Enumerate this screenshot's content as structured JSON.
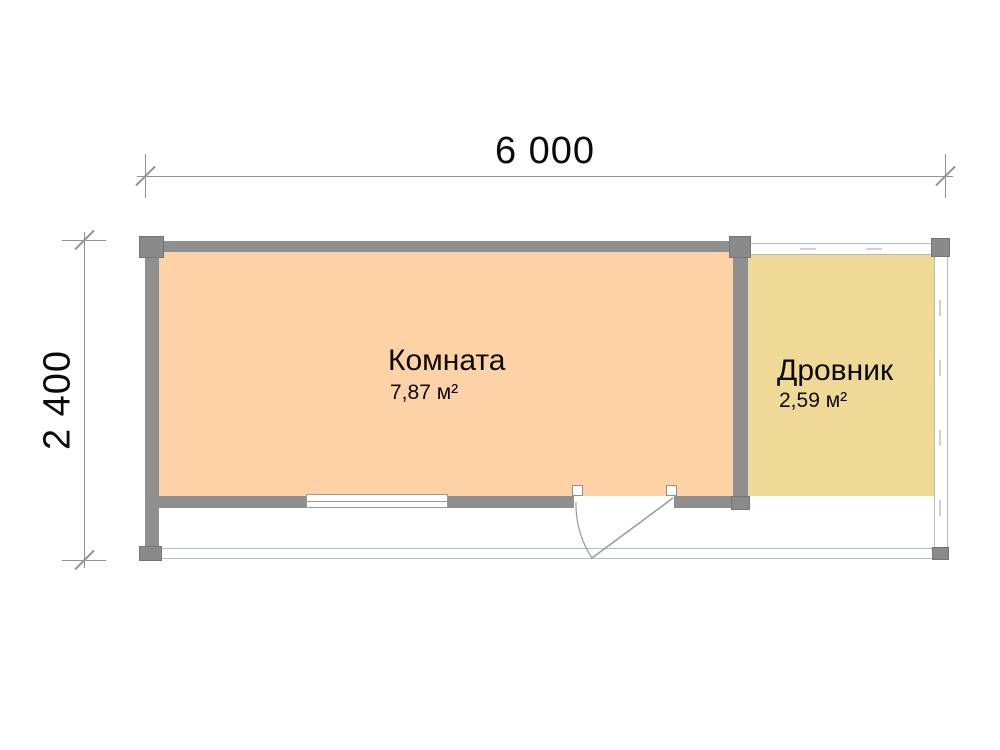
{
  "plan": {
    "dim_width": "6 000",
    "dim_height": "2 400",
    "rooms": [
      {
        "name": "Комната",
        "area": "7,87 м²"
      },
      {
        "name": "Дровник",
        "area": "2,59 м²"
      }
    ],
    "colors": {
      "room_fill": "#fcd2a6",
      "shed_fill": "#efd996",
      "wall": "#8f8f8f",
      "post": "#8a8a8a",
      "thin_line": "#b2bbbf",
      "dim_line": "#8f9496",
      "text": "#0a0a0a"
    }
  }
}
